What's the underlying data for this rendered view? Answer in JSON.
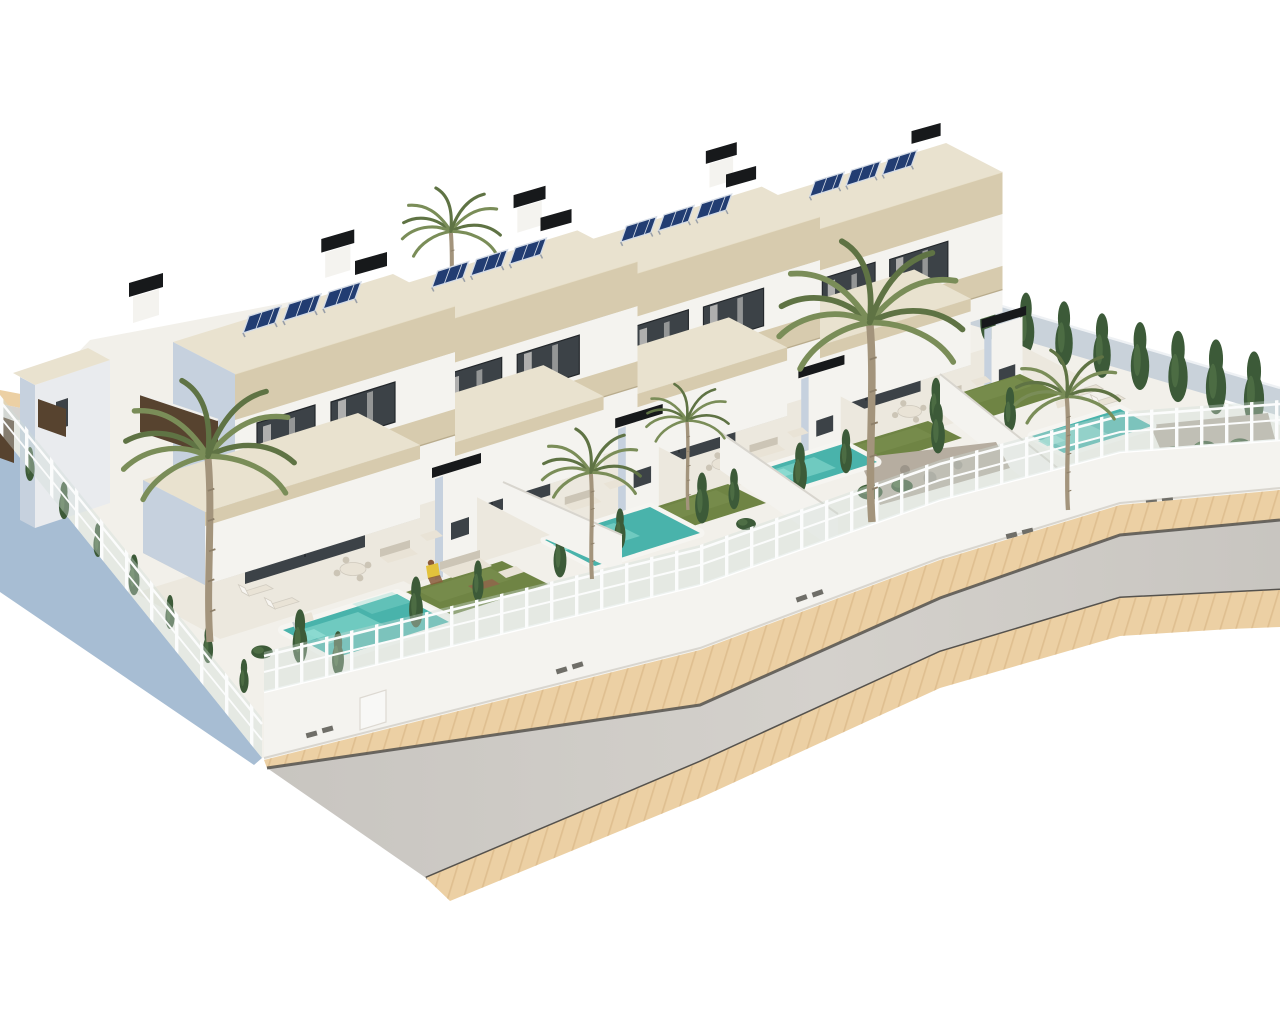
{
  "scene": {
    "type": "architectural-3d-render",
    "description": "Aerial 3D visualization of a row of four modern white two-storey villas, each with travertine roof fascias, rooftop solar panels, black chimney caps, a private turquoise pool, artificial lawn, palm trees and glass-topped perimeter walls, beside a curved asphalt road with beige paved sidewalks on a plain white background",
    "background": "white",
    "view": "isometric aerial from south-west"
  },
  "counts": {
    "villas": 4,
    "floors_per_villa": 2,
    "solar_panels_per_villa": 3,
    "pools": 4,
    "palm_trees": 6,
    "sun_loungers": 4,
    "lawns": 4,
    "people": 1,
    "perimeter_fence_sides": 2
  },
  "villas": [
    {
      "id": "villa-1",
      "transform": "translate(205,585)",
      "solar_panels": 3,
      "has_pool": true
    },
    {
      "id": "villa-2",
      "transform": "translate(395,532) scale(0.97)",
      "solar_panels": 3,
      "has_pool": true
    },
    {
      "id": "villa-3",
      "transform": "translate(585,479) scale(0.94)",
      "solar_panels": 3,
      "has_pool": true
    },
    {
      "id": "villa-4",
      "transform": "translate(775,426) scale(0.91)",
      "solar_panels": 3,
      "has_pool": true
    }
  ],
  "palms": [
    {
      "id": "palm-rear",
      "transform": "translate(452,338) scale(0.62)"
    },
    {
      "id": "palm-villa1",
      "transform": "translate(210,642) scale(1.08)"
    },
    {
      "id": "palm-villa2",
      "transform": "translate(592,579) scale(0.62)"
    },
    {
      "id": "palm-villa23",
      "transform": "translate(688,510) scale(0.52)"
    },
    {
      "id": "palm-villa3-tall",
      "transform": "translate(872,522) scale(1.16)"
    },
    {
      "id": "palm-villa4",
      "transform": "translate(1068,510) scale(0.66)"
    }
  ],
  "colors": {
    "ground": "#f2f0ea",
    "wall_white": "#f4f3ef",
    "wall_dim": "#e9ebee",
    "wall_blue_shadow": "#c6d1de",
    "back_wall_shadow": "#c9d2da",
    "travertine": "#d7cbae",
    "travertine_dark": "#c8bb9c",
    "roof_top": "#e9e2cf",
    "glass_dark": "#3c4247",
    "curtain": "#eceae6",
    "solar_panel": "#223d72",
    "solar_frame": "#d5dce6",
    "chimney_black": "#17191b",
    "retaining_blue": "#a7bdd3",
    "pool_water": "#49b3ab",
    "pool_light": "#8edcd2",
    "pool_coping": "#f6f5f1",
    "grass": "#6f8444",
    "grass_light": "#7e9252",
    "cypress": "#3c5a38",
    "cypress_light": "#527349",
    "palm_green": "#7a8d58",
    "palm_dark": "#5f7344",
    "palm_trunk": "#a3947c",
    "gravel": "#b6ada0",
    "boulder": "#9c958a",
    "sidewalk": "#ecd0a4",
    "sidewalk_line": "#d9b686",
    "road": "#c8c5c0",
    "road_light": "#d4d1cc",
    "road_line": "#55524d",
    "fence_post": "#fbfcfc",
    "fence_glass": "#cfdcd8",
    "terrace": "#ece8de",
    "furniture": "#e9e3d6",
    "furniture_shadow": "#ccc5b6",
    "wood": "#8b6a4a",
    "wood_dark": "#57432f",
    "vent": "#6f6e68",
    "skin": "#8a5a3a",
    "shirt_yellow": "#e3c23c"
  }
}
